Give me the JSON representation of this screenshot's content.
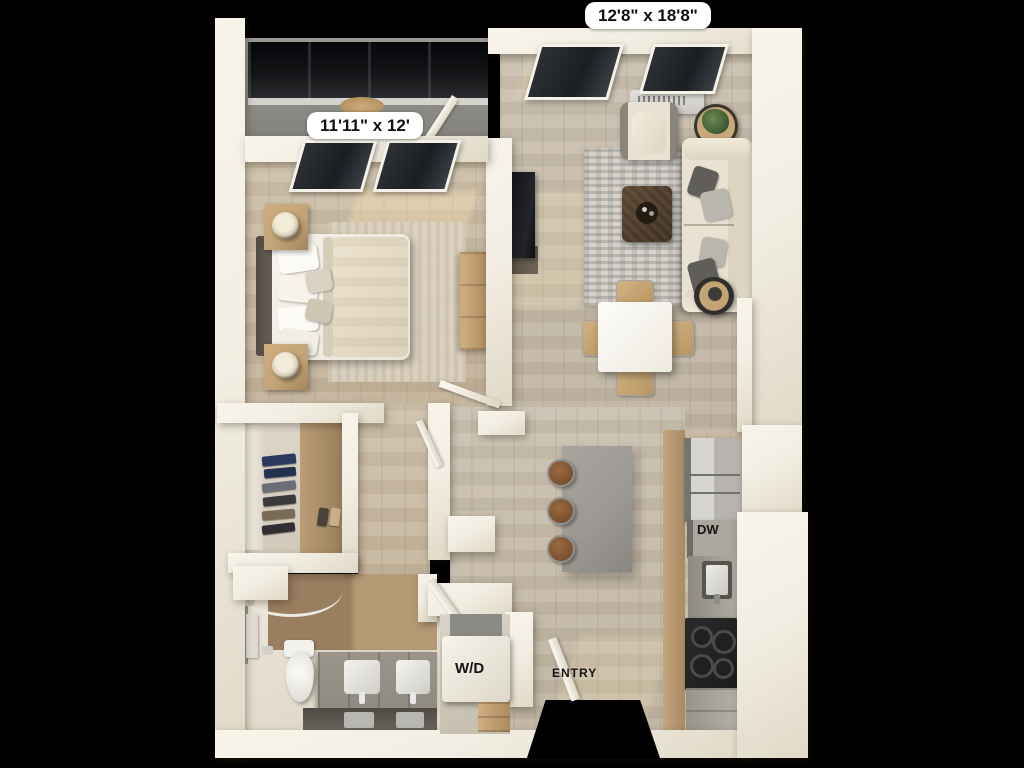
{
  "labels": {
    "living_room_dimensions": "12'8\" x 18'8\"",
    "bedroom_dimensions": "11'11\" x 12'",
    "washer_dryer": "W/D",
    "dishwasher": "DW",
    "entry": "ENTRY"
  },
  "colors": {
    "background": "#000000",
    "wall": "#f2eee3",
    "wall_shade": "#e0d9c7",
    "floor_wood": "#cfc2ad",
    "floor_living": "#ccc2b2",
    "balcony_floor": "#8f8e8a",
    "railing": "#141517",
    "window_glass": "#1b1e21",
    "rug_living": "#d6d3cd",
    "rug_bedroom": "#dcd3c2",
    "island": "#9c9893",
    "counter": "#908b82",
    "stainless": "#b7b4af",
    "stove": "#1c1c1c",
    "sofa": "#e9e2d2",
    "wood_furniture": "#c2a377",
    "plant": "#44603a",
    "label_bg": "#ffffff",
    "label_text": "#111111"
  }
}
